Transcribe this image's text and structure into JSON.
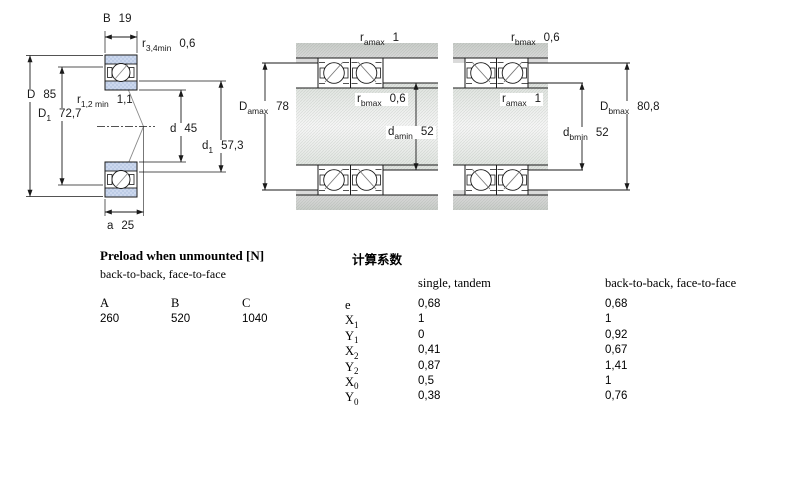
{
  "colors": {
    "line": "#1a1a1a",
    "contact_line": "#8a8a8a",
    "bearing_ring_fill": "#ccd8ee",
    "bearing_ring_dot": "#9db3d6",
    "panel_gray_dark": "#c9cdc9",
    "panel_gray_light": "#f6f6f6",
    "background": "#ffffff"
  },
  "left_drawing": {
    "b": {
      "base": "B",
      "sub": "",
      "value": "19"
    },
    "r34": {
      "base": "r",
      "sub": "3,4min",
      "value": "0,6"
    },
    "D": {
      "base": "D",
      "sub": "",
      "value": "85"
    },
    "D1": {
      "base": "D",
      "sub": "1",
      "value": "72,7"
    },
    "r12": {
      "base": "r",
      "sub": "1,2 min",
      "value": "1,1"
    },
    "d": {
      "base": "d",
      "sub": "",
      "value": "45"
    },
    "d1": {
      "base": "d",
      "sub": "1",
      "value": "57,3"
    },
    "a": {
      "base": "a",
      "sub": "",
      "value": "25"
    }
  },
  "middle_drawing": {
    "ramax": {
      "base": "r",
      "sub": "amax",
      "value": "1"
    },
    "Damax": {
      "base": "D",
      "sub": "amax",
      "value": "78"
    },
    "rbmax": {
      "base": "r",
      "sub": "bmax",
      "value": "0,6"
    },
    "damin": {
      "base": "d",
      "sub": "amin",
      "value": "52"
    }
  },
  "right_drawing": {
    "rbmax": {
      "base": "r",
      "sub": "bmax",
      "value": "0,6"
    },
    "ramax": {
      "base": "r",
      "sub": "amax",
      "value": "1"
    },
    "Dbmax": {
      "base": "D",
      "sub": "bmax",
      "value": "80,8"
    },
    "dbmin": {
      "base": "d",
      "sub": "bmin",
      "value": "52"
    }
  },
  "preload_table": {
    "title": "Preload when unmounted [N]",
    "subtitle": "back-to-back, face-to-face",
    "columns": [
      "A",
      "B",
      "C"
    ],
    "values": [
      "260",
      "520",
      "1040"
    ]
  },
  "factors_table": {
    "title": "计算系数",
    "col1_header": "single, tandem",
    "col2_header": "back-to-back, face-to-face",
    "rows": [
      {
        "base": "e",
        "sub": "",
        "single": "0,68",
        "btb": "0,68"
      },
      {
        "base": "X",
        "sub": "1",
        "single": "1",
        "btb": "1"
      },
      {
        "base": "Y",
        "sub": "1",
        "single": "0",
        "btb": "0,92"
      },
      {
        "base": "X",
        "sub": "2",
        "single": "0,41",
        "btb": "0,67"
      },
      {
        "base": "Y",
        "sub": "2",
        "single": "0,87",
        "btb": "1,41"
      },
      {
        "base": "X",
        "sub": "0",
        "single": "0,5",
        "btb": "1"
      },
      {
        "base": "Y",
        "sub": "0",
        "single": "0,38",
        "btb": "0,76"
      }
    ]
  }
}
